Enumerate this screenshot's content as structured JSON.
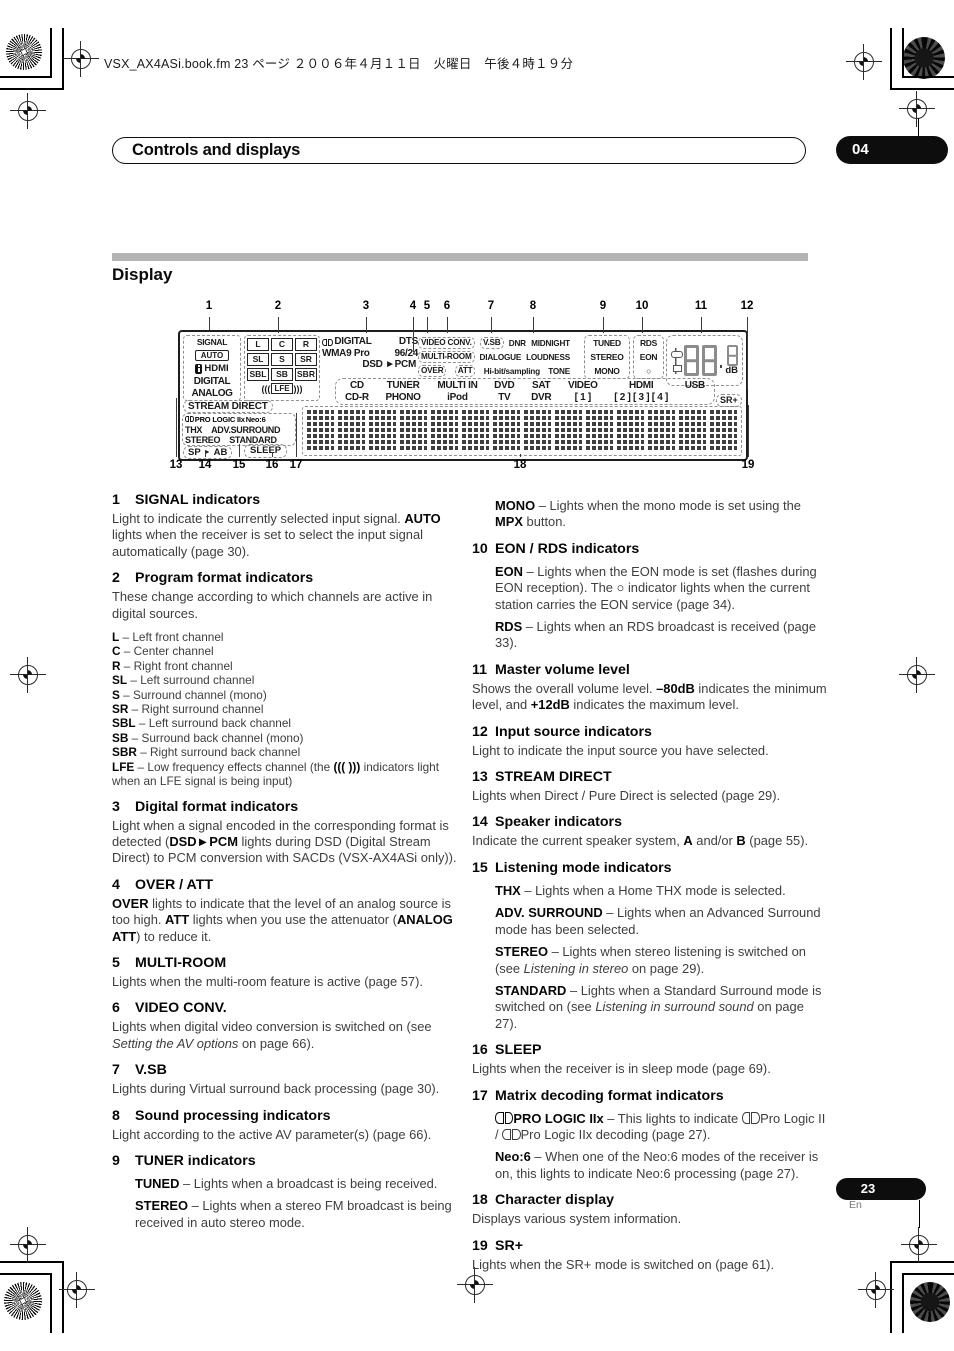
{
  "page": {
    "header": "VSX_AX4ASi.book.fm  23 ページ  ２００６年４月１１日　火曜日　午後４時１９分",
    "chapter_title": "Controls and displays",
    "chapter_num": "04",
    "section_title": "Display",
    "page_num": "23",
    "lang": "En"
  },
  "display": {
    "callouts_top": [
      "1",
      "2",
      "3",
      "4",
      "5",
      "6",
      "7",
      "8",
      "9",
      "10",
      "11",
      "12"
    ],
    "callouts_bottom": [
      "13",
      "14",
      "15",
      "16",
      "17",
      "18",
      "19"
    ],
    "signal": {
      "label": "SIGNAL",
      "auto": "AUTO",
      "hdmi": "HDMI",
      "digital": "DIGITAL",
      "analog": "ANALOG"
    },
    "channels": [
      [
        "L",
        "C",
        "R"
      ],
      [
        "SL",
        "S",
        "SR"
      ],
      [
        "SBL",
        "SB",
        "SBR"
      ]
    ],
    "lfe": {
      "pre": "(((",
      "label": "LFE",
      "post": ")))"
    },
    "formats": {
      "digital": "DIGITAL",
      "dts": "DTS",
      "wma": "WMA9 Pro",
      "hires": "96/24",
      "dsd": "DSD ►PCM"
    },
    "sound_proc": [
      [
        {
          "t": "VIDEO CONV.",
          "box": 1
        },
        {
          "t": "V.SB",
          "box": 1
        },
        {
          "t": "DNR"
        },
        {
          "t": "MIDNIGHT"
        }
      ],
      [
        {
          "t": "MULTI-ROOM",
          "box": 1
        },
        {
          "t": "DIALOGUE"
        },
        {
          "t": "LOUDNESS"
        }
      ],
      [
        {
          "t": "OVER",
          "box": 1
        },
        {
          "t": "ATT",
          "box": 1
        },
        {
          "t": "Hi-bit/sampling"
        },
        {
          "t": "TONE"
        }
      ]
    ],
    "tuner": [
      "TUNED",
      "STEREO",
      "MONO"
    ],
    "rds": [
      "RDS",
      "EON",
      "○"
    ],
    "volume_unit": "dB",
    "sources": [
      [
        "CD",
        "CD-R"
      ],
      [
        "TUNER",
        "PHONO"
      ],
      [
        "MULTI IN",
        "iPod"
      ],
      [
        "DVD",
        "TV"
      ],
      [
        "SAT",
        "DVR"
      ],
      [
        "VIDEO",
        "[ 1 ]"
      ],
      [
        "HDMI",
        "[ 2 ] [ 3 ] [ 4 ]"
      ],
      [
        "USB",
        ""
      ]
    ],
    "sr_plus": "SR+",
    "stream_direct": "STREAM DIRECT",
    "matrix": [
      {
        "g": "dd"
      },
      {
        "t": "PRO LOGIC IIx ",
        "b": 1
      },
      {
        "t": "Neo:6",
        "b": 1
      }
    ],
    "modes": [
      [
        "THX",
        "ADV.SURROUND"
      ],
      [
        "STEREO",
        "STANDARD"
      ]
    ],
    "speakers": {
      "sp": "SP",
      "arrow": "►",
      "ab": "AB"
    },
    "sleep": "SLEEP"
  },
  "sections_left": [
    {
      "num": "1",
      "title": "SIGNAL indicators",
      "blocks": [
        {
          "type": "p",
          "runs": [
            {
              "t": "Light to indicate the currently selected input signal. "
            },
            {
              "t": "AUTO",
              "b": 1
            },
            {
              "t": " lights when the receiver is set to select the input signal automatically (page 30)."
            }
          ]
        }
      ]
    },
    {
      "num": "2",
      "title": "Program format indicators",
      "blocks": [
        {
          "type": "p",
          "runs": [
            {
              "t": "These change according to which channels are active in digital sources."
            }
          ]
        },
        {
          "type": "defs",
          "lines": [
            [
              {
                "t": "L",
                "b": 1
              },
              {
                "t": " – Left front channel"
              }
            ],
            [
              {
                "t": "C",
                "b": 1
              },
              {
                "t": " – Center channel"
              }
            ],
            [
              {
                "t": "R",
                "b": 1
              },
              {
                "t": " – Right front channel"
              }
            ],
            [
              {
                "t": "SL",
                "b": 1
              },
              {
                "t": " – Left surround channel"
              }
            ],
            [
              {
                "t": "S",
                "b": 1
              },
              {
                "t": " – Surround channel (mono)"
              }
            ],
            [
              {
                "t": "SR",
                "b": 1
              },
              {
                "t": " – Right surround channel"
              }
            ],
            [
              {
                "t": "SBL",
                "b": 1
              },
              {
                "t": " – Left surround back channel"
              }
            ],
            [
              {
                "t": "SB",
                "b": 1
              },
              {
                "t": " – Surround back channel (mono)"
              }
            ],
            [
              {
                "t": "SBR",
                "b": 1
              },
              {
                "t": " – Right surround back channel"
              }
            ],
            [
              {
                "t": "LFE",
                "b": 1
              },
              {
                "t": " – Low frequency effects channel (the "
              },
              {
                "t": "((( )))",
                "b": 1
              },
              {
                "t": " indicators light when an LFE signal is being input)"
              }
            ]
          ]
        }
      ]
    },
    {
      "num": "3",
      "title": "Digital format indicators",
      "blocks": [
        {
          "type": "p",
          "runs": [
            {
              "t": "Light when a signal encoded in the corresponding format is detected ("
            },
            {
              "t": "DSD►PCM",
              "b": 1
            },
            {
              "t": " lights during DSD (Digital Stream Direct) to PCM conversion with SACDs (VSX-AX4ASi only))."
            }
          ]
        }
      ]
    },
    {
      "num": "4",
      "title": "OVER / ATT",
      "blocks": [
        {
          "type": "p",
          "runs": [
            {
              "t": "OVER",
              "b": 1
            },
            {
              "t": " lights to indicate that the level of an analog source is too high. "
            },
            {
              "t": "ATT",
              "b": 1
            },
            {
              "t": " lights when you use the attenuator ("
            },
            {
              "t": "ANALOG ATT",
              "b": 1
            },
            {
              "t": ") to reduce it."
            }
          ]
        }
      ]
    },
    {
      "num": "5",
      "title": "MULTI-ROOM",
      "blocks": [
        {
          "type": "p",
          "runs": [
            {
              "t": "Lights when the multi-room feature is active (page 57)."
            }
          ]
        }
      ]
    },
    {
      "num": "6",
      "title": "VIDEO CONV.",
      "blocks": [
        {
          "type": "p",
          "runs": [
            {
              "t": "Lights when digital video conversion is switched on (see "
            },
            {
              "t": "Setting the AV options",
              "i": 1
            },
            {
              "t": " on page 66)."
            }
          ]
        }
      ]
    },
    {
      "num": "7",
      "title": "V.SB",
      "blocks": [
        {
          "type": "p",
          "runs": [
            {
              "t": "Lights during Virtual surround back processing (page 30)."
            }
          ]
        }
      ]
    },
    {
      "num": "8",
      "title": "Sound processing indicators",
      "blocks": [
        {
          "type": "p",
          "runs": [
            {
              "t": "Light according to the active AV parameter(s) (page 66)."
            }
          ]
        }
      ]
    },
    {
      "num": "9",
      "title": "TUNER indicators",
      "blocks": [
        {
          "type": "sub",
          "runs": [
            {
              "t": "TUNED",
              "b": 1
            },
            {
              "t": " – Lights when a broadcast is being received."
            }
          ]
        },
        {
          "type": "sub",
          "runs": [
            {
              "t": "STEREO",
              "b": 1
            },
            {
              "t": " – Lights when a stereo FM broadcast is being received in auto stereo mode."
            }
          ]
        }
      ]
    }
  ],
  "sections_right": [
    {
      "num": "",
      "title": "",
      "blocks": [
        {
          "type": "sub",
          "runs": [
            {
              "t": "MONO",
              "b": 1
            },
            {
              "t": " – Lights when the mono mode is set using the "
            },
            {
              "t": "MPX",
              "b": 1
            },
            {
              "t": " button."
            }
          ]
        }
      ]
    },
    {
      "num": "10",
      "title": "EON / RDS indicators",
      "blocks": [
        {
          "type": "sub",
          "runs": [
            {
              "t": "EON",
              "b": 1
            },
            {
              "t": " – Lights when the EON mode is set (flashes during EON reception). The "
            },
            {
              "t": "○",
              "b": 1
            },
            {
              "t": " indicator lights when the current station carries the EON service (page 34)."
            }
          ]
        },
        {
          "type": "sub",
          "runs": [
            {
              "t": "RDS",
              "b": 1
            },
            {
              "t": " – Lights when an RDS broadcast is received (page 33)."
            }
          ]
        }
      ]
    },
    {
      "num": "11",
      "title": "Master volume level",
      "blocks": [
        {
          "type": "p",
          "runs": [
            {
              "t": "Shows the overall volume level. "
            },
            {
              "t": "–80dB",
              "b": 1
            },
            {
              "t": " indicates the minimum level, and "
            },
            {
              "t": "+12dB",
              "b": 1
            },
            {
              "t": " indicates the maximum level."
            }
          ]
        }
      ]
    },
    {
      "num": "12",
      "title": "Input source indicators",
      "blocks": [
        {
          "type": "p",
          "runs": [
            {
              "t": "Light to indicate the input source you have selected."
            }
          ]
        }
      ]
    },
    {
      "num": "13",
      "title": "STREAM DIRECT",
      "blocks": [
        {
          "type": "p",
          "runs": [
            {
              "t": "Lights when Direct / Pure Direct is selected (page 29)."
            }
          ]
        }
      ]
    },
    {
      "num": "14",
      "title": "Speaker indicators",
      "blocks": [
        {
          "type": "p",
          "runs": [
            {
              "t": "Indicate the current speaker system, "
            },
            {
              "t": "A",
              "b": 1
            },
            {
              "t": " and/or "
            },
            {
              "t": "B",
              "b": 1
            },
            {
              "t": " (page 55)."
            }
          ]
        }
      ]
    },
    {
      "num": "15",
      "title": "Listening mode indicators",
      "blocks": [
        {
          "type": "sub",
          "runs": [
            {
              "t": "THX",
              "b": 1
            },
            {
              "t": " – Lights when a Home THX mode is selected."
            }
          ]
        },
        {
          "type": "sub",
          "runs": [
            {
              "t": "ADV. SURROUND",
              "b": 1
            },
            {
              "t": " – Lights when an Advanced Surround mode has been selected."
            }
          ]
        },
        {
          "type": "sub",
          "runs": [
            {
              "t": "STEREO",
              "b": 1
            },
            {
              "t": " – Lights when stereo listening is switched on (see "
            },
            {
              "t": "Listening in stereo",
              "i": 1
            },
            {
              "t": " on page 29)."
            }
          ]
        },
        {
          "type": "sub",
          "runs": [
            {
              "t": "STANDARD",
              "b": 1
            },
            {
              "t": " – Lights when a Standard Surround mode is switched on (see "
            },
            {
              "t": "Listening in surround sound",
              "i": 1
            },
            {
              "t": " on page 27)."
            }
          ]
        }
      ]
    },
    {
      "num": "16",
      "title": "SLEEP",
      "blocks": [
        {
          "type": "p",
          "runs": [
            {
              "t": "Lights when the receiver is in sleep mode (page 69)."
            }
          ]
        }
      ]
    },
    {
      "num": "17",
      "title": "Matrix decoding format indicators",
      "blocks": [
        {
          "type": "sub",
          "runs": [
            {
              "g": "dd",
              "b": 1
            },
            {
              "t": "PRO LOGIC IIx",
              "b": 1
            },
            {
              "t": " – This lights to indicate "
            },
            {
              "g": "dd"
            },
            {
              "t": "Pro Logic II / "
            },
            {
              "g": "dd"
            },
            {
              "t": "Pro Logic IIx decoding (page 27)."
            }
          ]
        },
        {
          "type": "sub",
          "runs": [
            {
              "t": "Neo:6",
              "b": 1
            },
            {
              "t": " – When one of the Neo:6 modes of the receiver is on, this lights to indicate Neo:6 processing (page 27)."
            }
          ]
        }
      ]
    },
    {
      "num": "18",
      "title": "Character display",
      "blocks": [
        {
          "type": "p",
          "runs": [
            {
              "t": "Displays various system information."
            }
          ]
        }
      ]
    },
    {
      "num": "19",
      "title": "SR+",
      "blocks": [
        {
          "type": "p",
          "runs": [
            {
              "t": "Lights when the SR+ mode is switched on (page 61)."
            }
          ]
        }
      ]
    }
  ]
}
